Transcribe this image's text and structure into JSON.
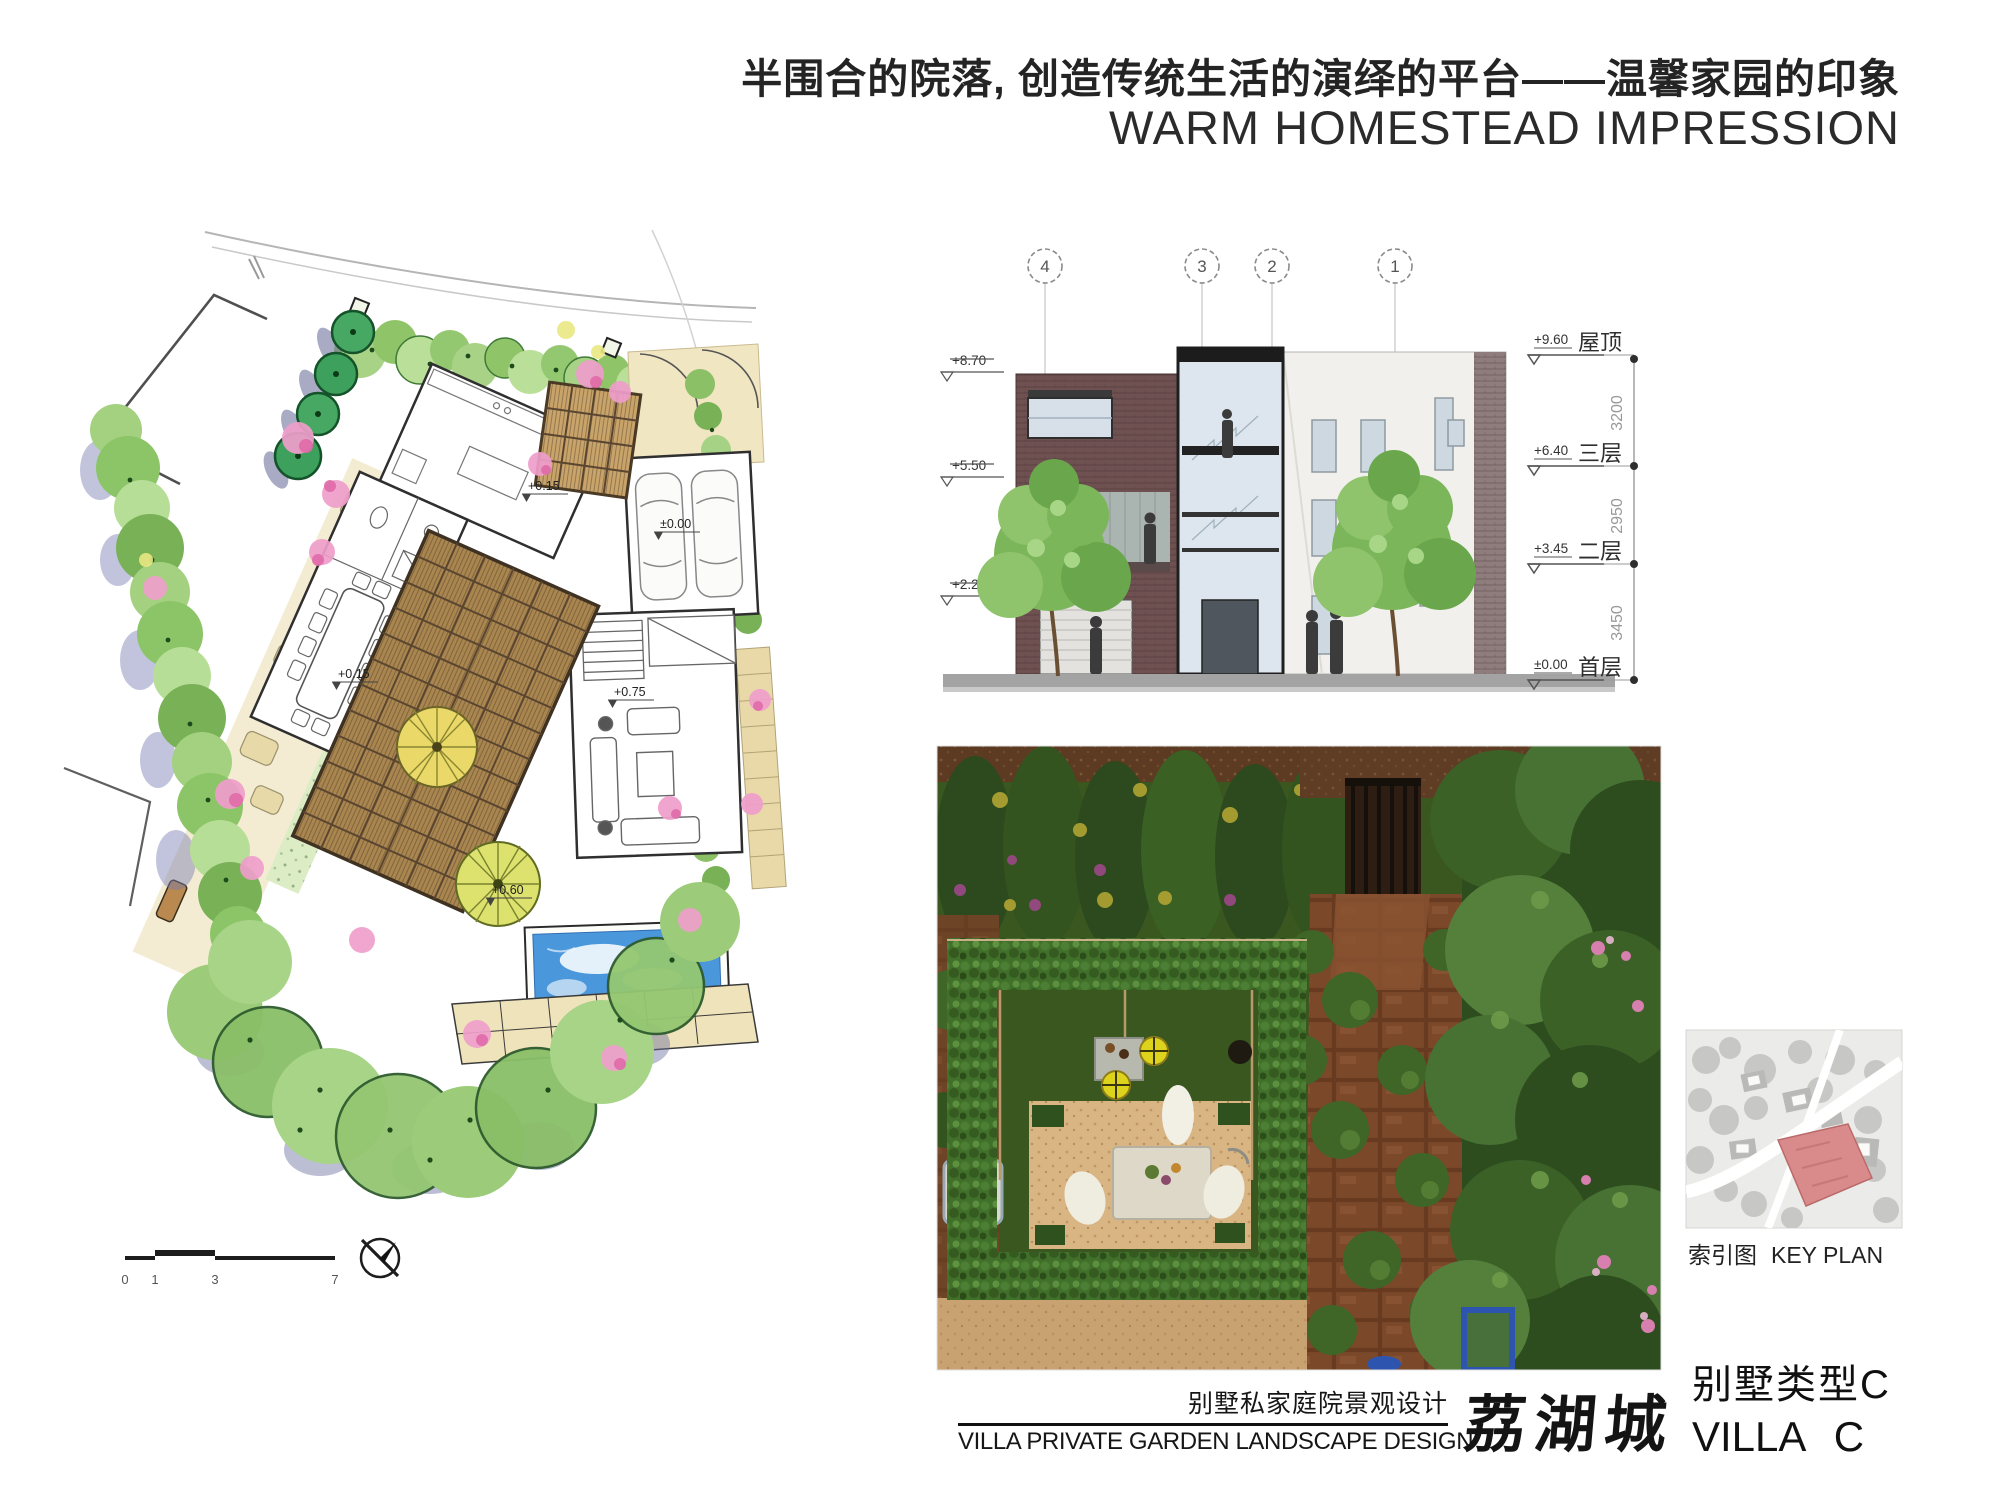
{
  "header": {
    "title_cn": "半围合的院落, 创造传统生活的演绎的平台——温馨家园的印象",
    "title_en": "WARM HOMESTEAD IMPRESSION"
  },
  "elevation": {
    "bubbles": [
      "4",
      "3",
      "2",
      "1"
    ],
    "left_levels": [
      {
        "label": "+8.70"
      },
      {
        "label": "+5.50"
      },
      {
        "label": "+2.2"
      }
    ],
    "right_levels": [
      {
        "value": "+9.60",
        "name": "屋顶"
      },
      {
        "value": "+6.40",
        "name": "三层"
      },
      {
        "value": "+3.45",
        "name": "二层"
      },
      {
        "value": "±0.00",
        "name": "首层"
      }
    ],
    "dims": [
      "3200",
      "2950",
      "3450"
    ]
  },
  "plan": {
    "labels": [
      {
        "text": "+0.15"
      },
      {
        "text": "±0.00"
      },
      {
        "text": "+0.15"
      },
      {
        "text": "+0.75"
      },
      {
        "text": "+0.60"
      }
    ],
    "scalebar": {
      "ticks": [
        "0",
        "1",
        "3",
        "7"
      ]
    }
  },
  "keyplan": {
    "caption_cn": "索引图",
    "caption_en": "KEY PLAN"
  },
  "footer": {
    "subtitle_cn": "别墅私家庭院景观设计",
    "subtitle_en": "VILLA  PRIVATE GARDEN LANDSCAPE DESIGN",
    "logo": "荔湖城",
    "type_cn": "别墅类型C",
    "type_en": "VILLA C"
  },
  "colors": {
    "accent_red_parcel": "#d98b8b",
    "pool_blue": "#4a97dc",
    "deck_brown": "#a9854f",
    "foliage_green": "#8cc066",
    "flower_pink": "#ef9ecb"
  }
}
